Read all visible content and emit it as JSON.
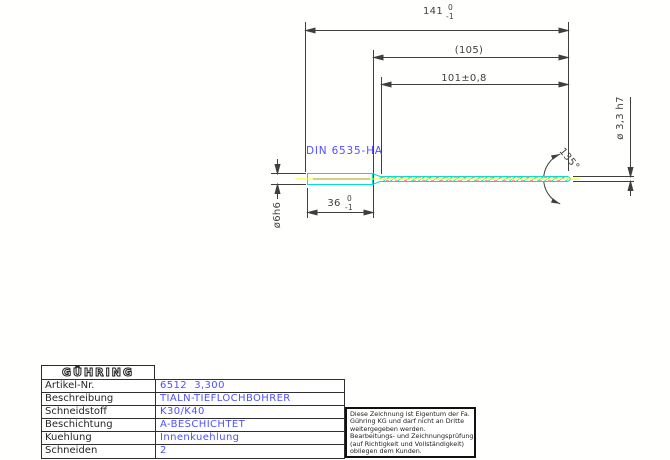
{
  "drawing": {
    "din_label": "DIN 6535-HA",
    "dims": {
      "overall": {
        "value": "141",
        "tol_upper": "0",
        "tol_lower": "-1"
      },
      "reference": "(105)",
      "flute_length": "101±0,8",
      "tip_diameter": "ø 3,3 h7",
      "point_angle": "135°",
      "shank_diameter": "ø6h6",
      "shank_length": {
        "value": "36",
        "tol_upper": "0",
        "tol_lower": "-1"
      }
    },
    "colors": {
      "outline_cyan": "#00dede",
      "centerline_yellow": "#ffff00",
      "centerline_olive": "#a0a000",
      "flute_dash_red": "#ff8080",
      "dimension_gray": "#3f3f3f",
      "annotation_blue": "#5050ff"
    }
  },
  "title_block": {
    "logo": "GÜHRING",
    "rows": [
      {
        "label": "Artikel-Nr.",
        "value": "6512  3,300"
      },
      {
        "label": "Beschreibung",
        "value": "TIALN-TIEFLOCHBOHRER"
      },
      {
        "label": "Schneidstoff",
        "value": "K30/K40"
      },
      {
        "label": "Beschichtung",
        "value": "A-BESCHICHTET"
      },
      {
        "label": "Kuehlung",
        "value": "Innenkuehlung"
      },
      {
        "label": "Schneiden",
        "value": "2"
      }
    ]
  },
  "disclaimer": {
    "lines": [
      "Diese Zeichnung ist Eigentum der Fa.",
      "Gühring KG und darf nicht an Dritte",
      "weitergegeben werden.",
      "Bearbeitungs- und Zeichnungsprüfung",
      "(auf Richtigkeit und Vollständigkeit)",
      "obliegen dem Kunden."
    ]
  }
}
